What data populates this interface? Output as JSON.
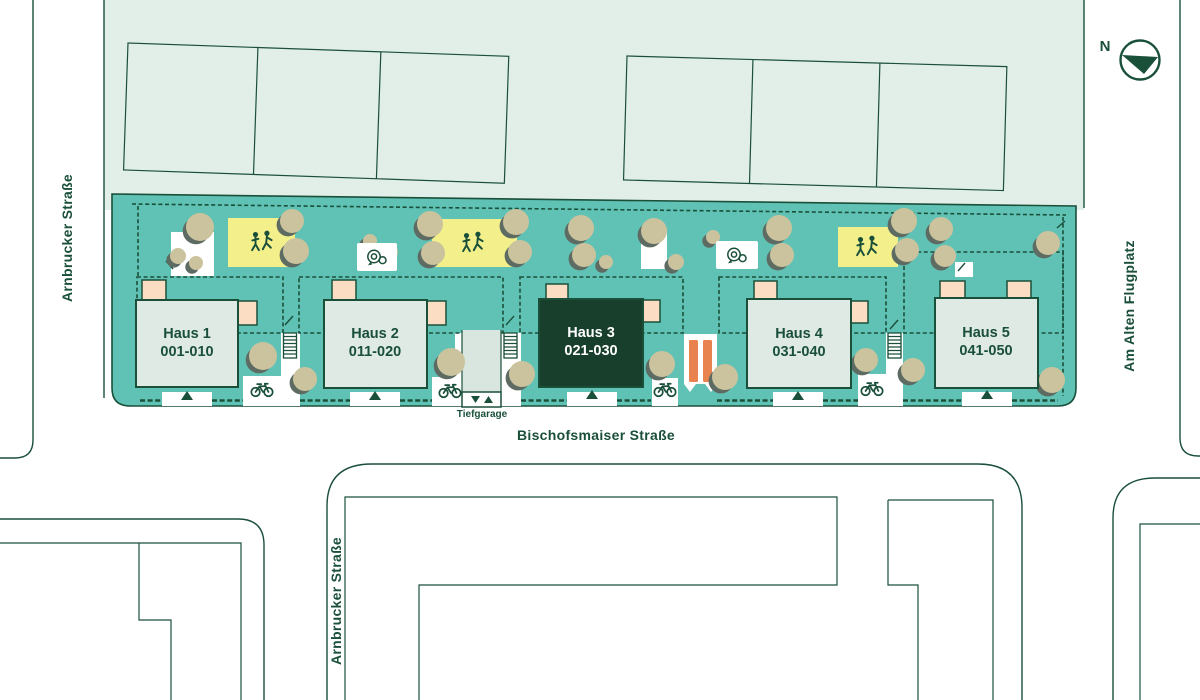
{
  "colors": {
    "dark": "#1a4f3a",
    "teal": "#60c2b5",
    "pale": "#e2efe9",
    "house": "#dfeae5",
    "houseSel": "#173f2c",
    "peach": "#fbddc3",
    "yellow": "#f3f08c",
    "tree": "#cbc39d",
    "treeShadow": "#5d6b63",
    "orange": "#e8824e",
    "ramp": "#d8e6df"
  },
  "compass": {
    "label": "N"
  },
  "streets": {
    "left_vertical": "Arnbrucker Straße",
    "bottom_vertical": "Arnbrucker Straße",
    "right_vertical": "Am Alten Flugplatz",
    "main_horizontal": "Bischofsmaiser Straße"
  },
  "underground_garage": {
    "label": "Tiefgarage"
  },
  "houses": [
    {
      "name": "Haus 1",
      "units": "001-010",
      "highlighted": false
    },
    {
      "name": "Haus 2",
      "units": "011-020",
      "highlighted": false
    },
    {
      "name": "Haus 3",
      "units": "021-030",
      "highlighted": true
    },
    {
      "name": "Haus 4",
      "units": "031-040",
      "highlighted": false
    },
    {
      "name": "Haus 5",
      "units": "041-050",
      "highlighted": false
    }
  ],
  "icons": {
    "compass": "compass-north-icon",
    "playground": "playing-children-icon",
    "bicycle_parking": "bicycle-icon",
    "play_point": "spiral-play-element-icon",
    "slide": "orange-slide-icon",
    "stairs": "stairs-icon",
    "entrance": "entrance-triangle-icon",
    "garage_down": "arrow-down-icon",
    "garage_up": "arrow-up-icon"
  }
}
